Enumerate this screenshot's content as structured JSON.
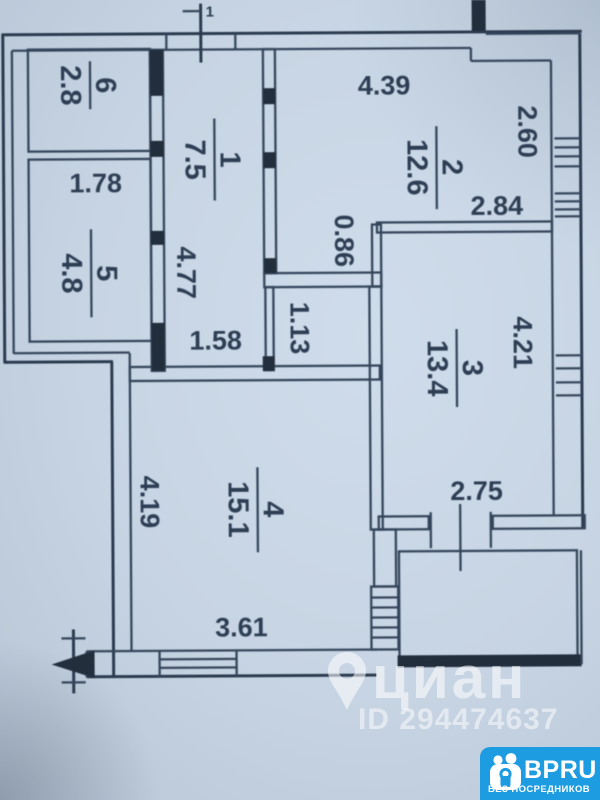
{
  "photo": {
    "paper_color": "#c7d4e3",
    "ink_color": "#2d3d53"
  },
  "plan": {
    "section_mark_label": "1",
    "rooms": [
      {
        "number": "1",
        "area": "7.5"
      },
      {
        "number": "2",
        "area": "12.6"
      },
      {
        "number": "3",
        "area": "13.4"
      },
      {
        "number": "4",
        "area": "15.1"
      },
      {
        "number": "5",
        "area": "4.8"
      },
      {
        "number": "6",
        "area": "2.8"
      }
    ],
    "dimensions": {
      "room2_width": "4.39",
      "room2_depth": "2.60",
      "room2_inner": "2.84",
      "step": "0.86",
      "room5_width": "1.78",
      "hall_length": "4.77",
      "hall_width_bottom": "1.58",
      "closet_width": "1.13",
      "room3_depth": "4.21",
      "room3_door": "2.75",
      "room4_length": "4.19",
      "room4_width": "3.61"
    }
  },
  "watermark": {
    "brand": "циан",
    "listing_id": "ID 294474637"
  },
  "badge": {
    "brand": "BPRU",
    "tagline": "БЕЗ ПОСРЕДНИКОВ",
    "color": "#1e9ce2"
  }
}
